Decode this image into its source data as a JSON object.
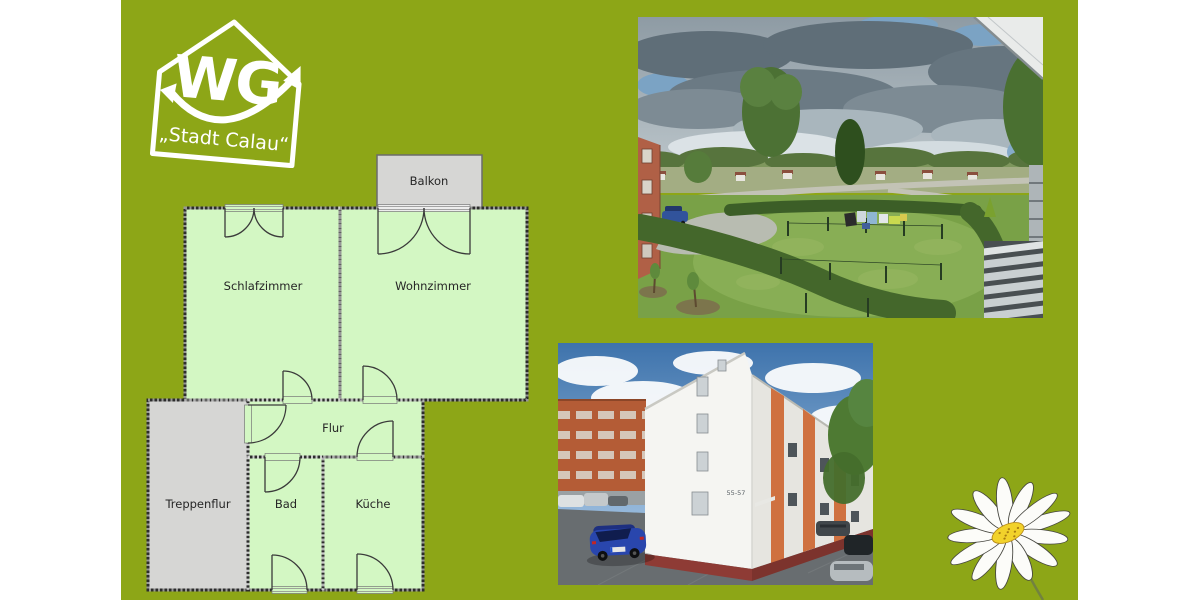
{
  "logo": {
    "acronym": "WG",
    "subtitle": "„Stadt Calau“"
  },
  "floorplan": {
    "rooms": [
      {
        "label": "Balkon"
      },
      {
        "label": "Schlafzimmer"
      },
      {
        "label": "Wohnzimmer"
      },
      {
        "label": "Flur"
      },
      {
        "label": "Treppenflur"
      },
      {
        "label": "Bad"
      },
      {
        "label": "Küche"
      }
    ]
  },
  "building_photo": {
    "house_number": "55-57"
  },
  "colors": {
    "bg": "#8da617",
    "room_green": "#d3f7c3",
    "room_gray": "#d6d6d4",
    "wall": "#2c2c2c",
    "label_text": "#262626",
    "logo_white": "#ffffff",
    "daisy_yellow": "#f2d22b"
  }
}
